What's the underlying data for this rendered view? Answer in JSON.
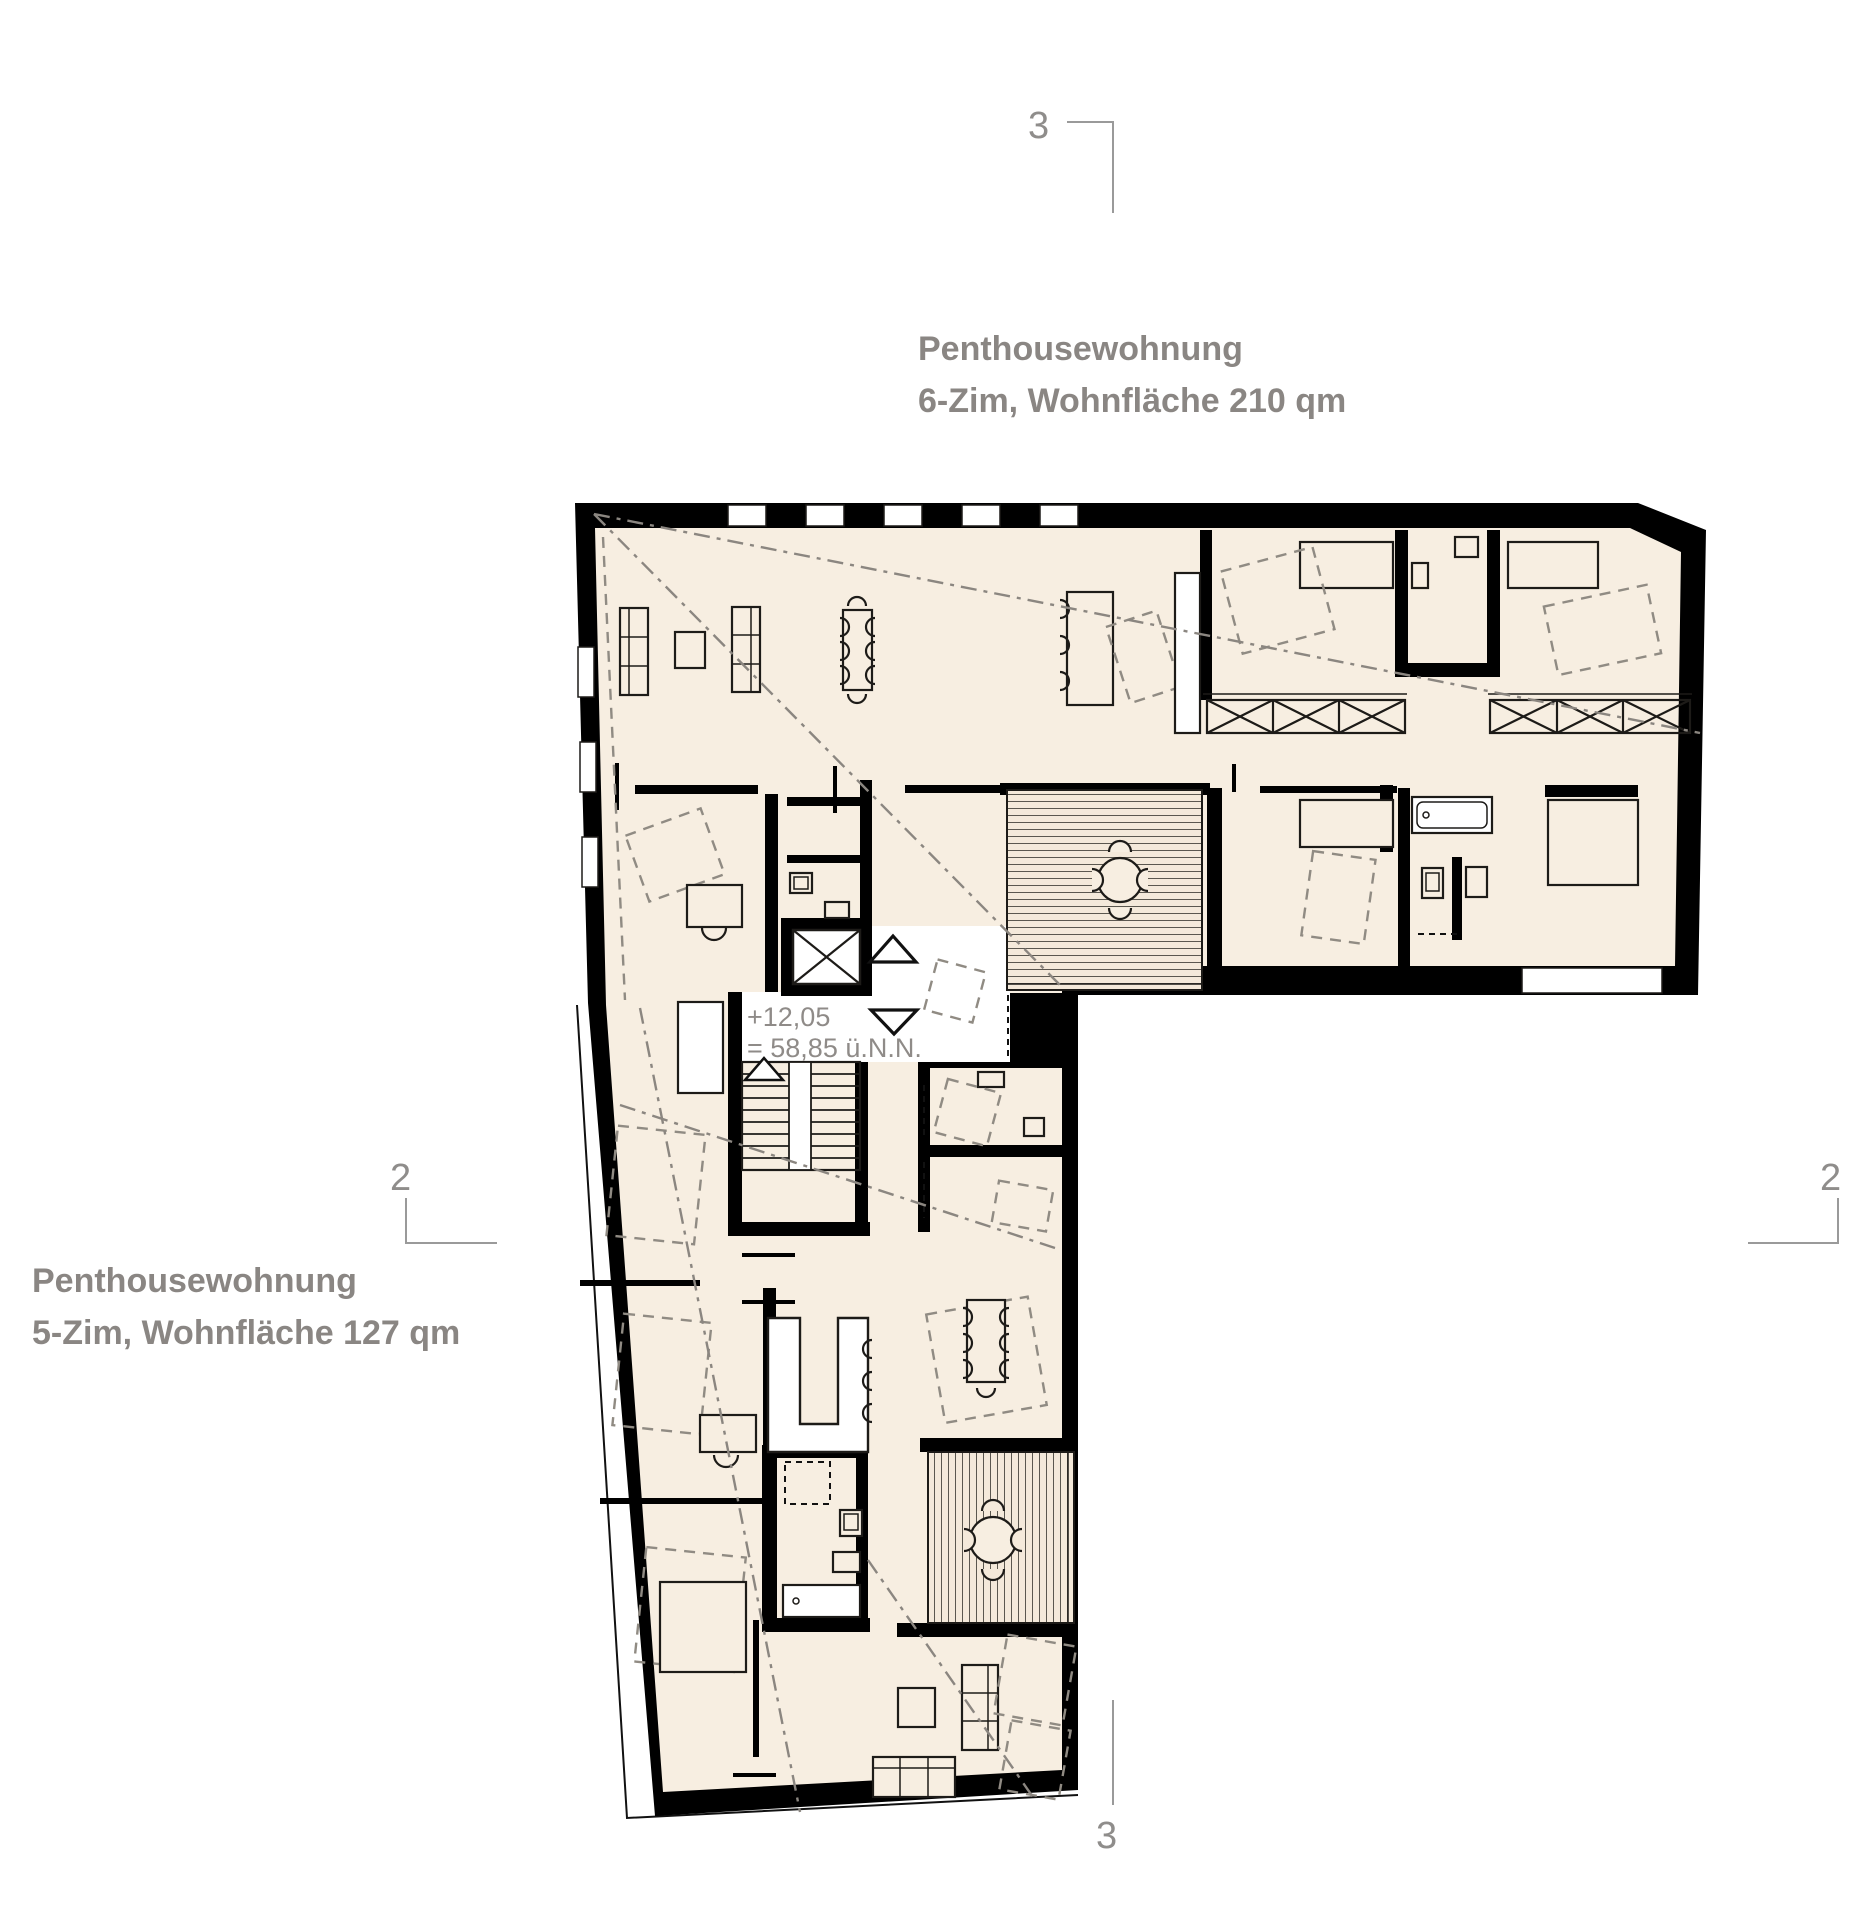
{
  "plan": {
    "apartment_upper": {
      "line1": "Penthousewohnung",
      "line2": "6-Zim, Wohnfläche 210 qm"
    },
    "apartment_lower": {
      "line1": "Penthousewohnung",
      "line2": "5-Zim, Wohnfläche 127 qm"
    },
    "elevation": {
      "line1": "+12,05",
      "line2": "= 58,85 ü.N.N."
    },
    "section_markers": {
      "top": "3",
      "bottom": "3",
      "left": "2",
      "right": "2"
    },
    "colors": {
      "floor": "#f7eee1",
      "wall": "#000000",
      "line": "#1d1b18",
      "furniture_dashed": "#908b83",
      "roof_dashdot": "#8b8680",
      "annotation": "#8a8683",
      "background": "#ffffff"
    }
  }
}
